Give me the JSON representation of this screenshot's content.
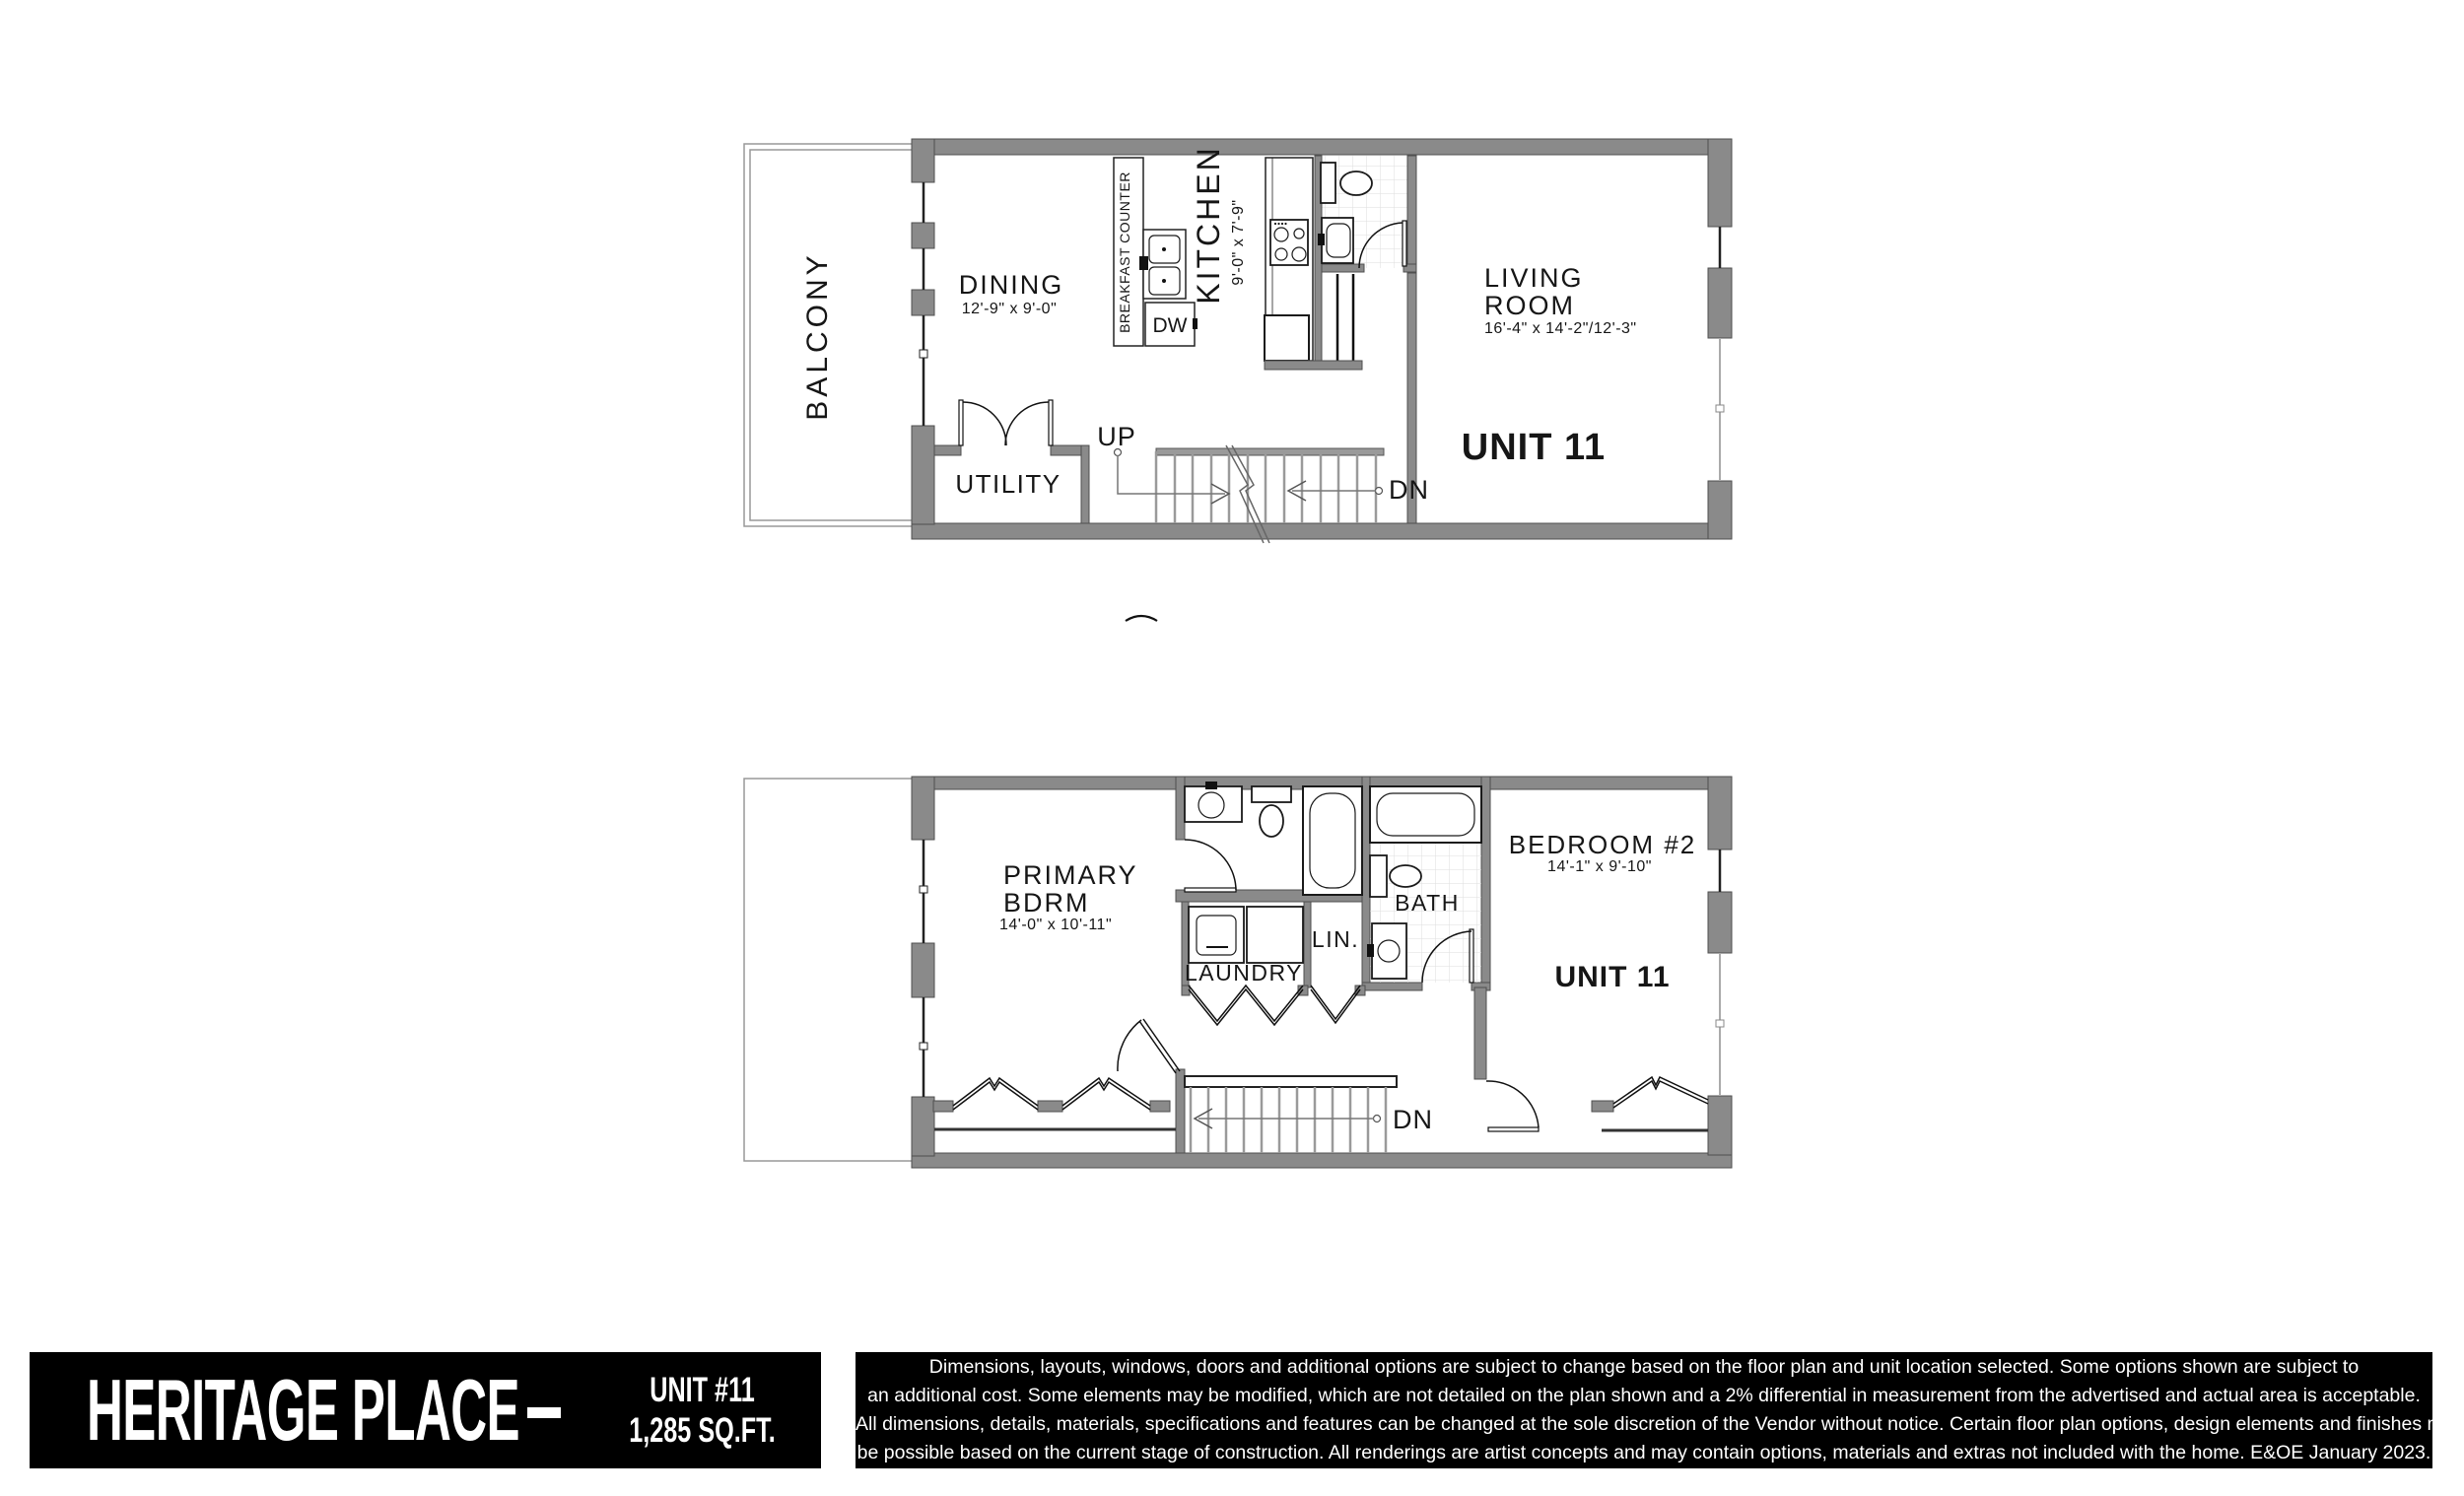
{
  "colors": {
    "wall": "#8a8a8a",
    "bar_bg": "#000000",
    "text": "#161616"
  },
  "floor1": {
    "balcony": "BALCONY",
    "dining": {
      "name": "DINING",
      "dims": "12'-9\" x 9'-0\""
    },
    "breakfast_counter": "BREAKFAST COUNTER",
    "dw": "DW",
    "kitchen": {
      "name": "KITCHEN",
      "dims": "9'-0\" x 7'-9\""
    },
    "living": {
      "name1": "LIVING",
      "name2": "ROOM",
      "dims": "16'-4\" x 14'-2\"/12'-3\""
    },
    "utility": "UTILITY",
    "up": "UP",
    "dn": "DN",
    "unit": "UNIT 11"
  },
  "floor2": {
    "primary": {
      "name1": "PRIMARY",
      "name2": "BDRM",
      "dims": "14'-0\" x 10'-11\""
    },
    "laundry": "LAUNDRY",
    "lin": "LIN.",
    "bath": "BATH",
    "bedroom2": {
      "name": "BEDROOM #2",
      "dims": "14'-1\" x 9'-10\""
    },
    "unit": "UNIT 11",
    "dn": "DN"
  },
  "footer": {
    "brand": "HERITAGE PLACE",
    "separator": "-",
    "unit_label": "UNIT #11",
    "area_label": "1,285 SQ.FT.",
    "disclaimer_lines": [
      "Dimensions, layouts, windows, doors and additional options are subject to change based on the floor plan and unit location selected. Some options shown are subject to",
      "an additional cost. Some elements may be modified, which are not detailed on the plan shown and a 2% differential in measurement from the advertised and actual area is acceptable.",
      "All dimensions, details, materials, specifications and features can be changed at the sole discretion of the Vendor without notice. Certain floor plan options, design elements and finishes may not",
      "be possible based on the current stage of construction. All renderings are artist concepts and may contain options, materials and extras not included with the home. E&OE January 2023."
    ]
  }
}
